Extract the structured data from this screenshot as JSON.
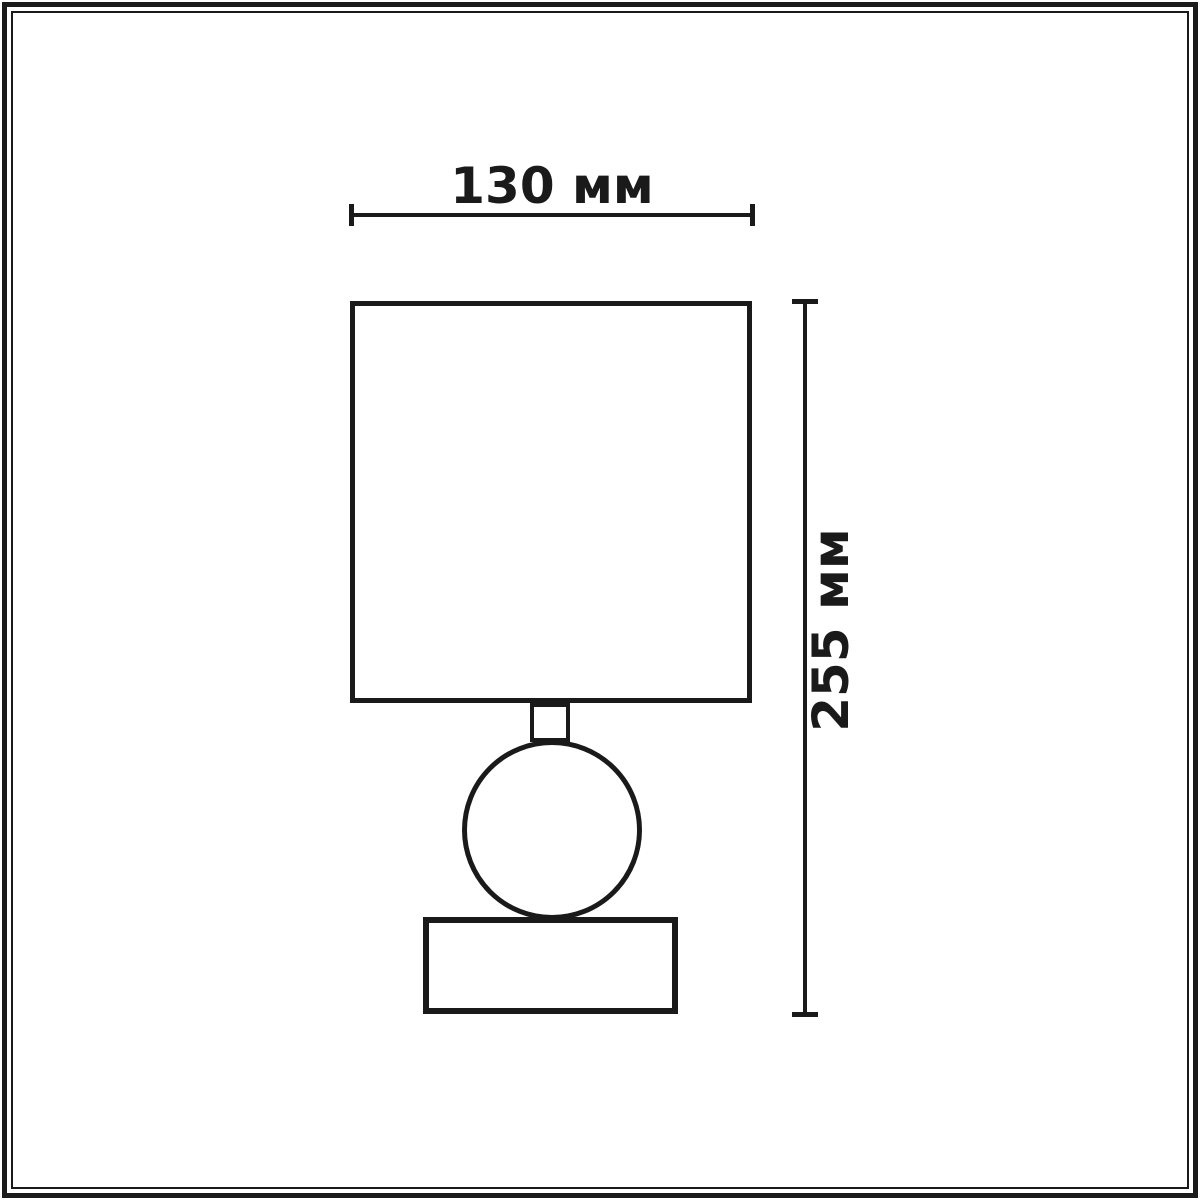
{
  "drawing": {
    "kind": "dimension-line-drawing",
    "background_color": "#ffffff",
    "line_color": "#1a1a1a",
    "frame": {
      "style": "double-border",
      "color": "#1a1a1a"
    },
    "width_dimension": {
      "label": "130 мм",
      "value": 130,
      "unit": "мм",
      "orientation": "horizontal"
    },
    "height_dimension": {
      "label": "255 мм",
      "value": 255,
      "unit": "мм",
      "orientation": "vertical"
    },
    "parts": [
      "lampshade",
      "neck",
      "sphere-body",
      "base"
    ]
  }
}
